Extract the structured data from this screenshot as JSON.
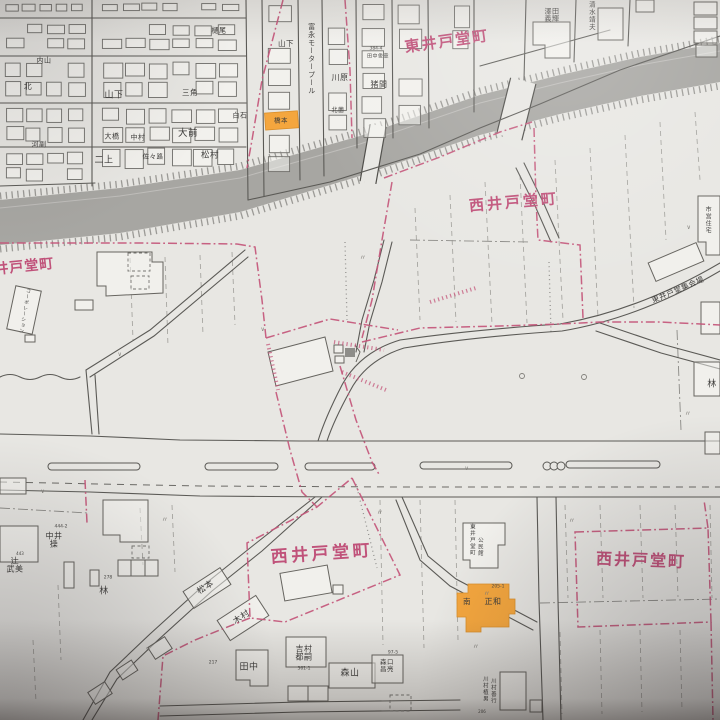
{
  "colors": {
    "paper": "#e8e7e3",
    "band_gray": "#a7a6a2",
    "boundary_pink": "#c4567a",
    "label_pink": "#c0527a",
    "highlight_orange": "#f4a63e",
    "ink": "#3f3e3c"
  },
  "district_labels": [
    {
      "t": "東井戸堂町",
      "x": 447,
      "y": 42,
      "s": 15,
      "r": -8,
      "ls": 2
    },
    {
      "t": "西井戸堂町",
      "x": 514,
      "y": 203,
      "s": 15,
      "r": -5,
      "ls": 3
    },
    {
      "t": "西井戸堂町",
      "x": 17,
      "y": 268,
      "s": 14,
      "r": -6,
      "ls": 1
    },
    {
      "t": "西井戸堂町",
      "x": 322,
      "y": 555,
      "s": 17,
      "r": -4,
      "ls": 3.5
    },
    {
      "t": "西井戸堂町",
      "x": 641,
      "y": 561,
      "s": 16,
      "r": 2,
      "ls": 2
    }
  ],
  "name_labels": [
    {
      "t": "内山",
      "x": 44,
      "y": 61,
      "s": 7
    },
    {
      "t": "北",
      "x": 28,
      "y": 87,
      "s": 8
    },
    {
      "t": "山下",
      "x": 114,
      "y": 96,
      "s": 9
    },
    {
      "t": "三角",
      "x": 190,
      "y": 93,
      "s": 7.5
    },
    {
      "t": "樋尾",
      "x": 219,
      "y": 31,
      "s": 7
    },
    {
      "t": "白石",
      "x": 240,
      "y": 116,
      "s": 7
    },
    {
      "t": "大橋",
      "x": 112,
      "y": 137,
      "s": 7
    },
    {
      "t": "中村",
      "x": 138,
      "y": 138,
      "s": 7
    },
    {
      "t": "河副",
      "x": 39,
      "y": 145,
      "s": 7
    },
    {
      "t": "二上",
      "x": 104,
      "y": 161,
      "s": 9
    },
    {
      "t": "佐々路",
      "x": 153,
      "y": 157,
      "s": 6.5
    },
    {
      "t": "大前",
      "x": 188,
      "y": 134,
      "s": 9.5
    },
    {
      "t": "松村",
      "x": 210,
      "y": 156,
      "s": 8.5
    },
    {
      "t": "山下",
      "x": 286,
      "y": 44,
      "s": 7.5
    },
    {
      "t": "川原",
      "x": 340,
      "y": 78,
      "s": 8
    },
    {
      "t": "猪間",
      "x": 379,
      "y": 85,
      "s": 8
    },
    {
      "t": "北薗",
      "x": 338,
      "y": 111,
      "s": 6
    },
    {
      "t": "田中俊章",
      "x": 378,
      "y": 57,
      "s": 5
    },
    {
      "t": "澤田\n義輝",
      "x": 552,
      "y": 16,
      "s": 7,
      "m": 1
    },
    {
      "t": "清水靖夫",
      "x": 591,
      "y": 16,
      "s": 6.5,
      "v": 1
    },
    {
      "t": "富永モータープール",
      "x": 311,
      "y": 59,
      "s": 7,
      "v": 1
    },
    {
      "t": "市営住宅",
      "x": 707,
      "y": 220,
      "s": 6,
      "v": 1
    },
    {
      "t": "コーポレーション",
      "x": 24,
      "y": 311,
      "s": 4.8,
      "v": 1,
      "r": 10
    },
    {
      "t": "東井戸堂集会場",
      "x": 678,
      "y": 290,
      "s": 7.5,
      "r": -23
    },
    {
      "t": "林",
      "x": 712,
      "y": 385,
      "s": 9
    },
    {
      "t": "中井\n操",
      "x": 54,
      "y": 541,
      "s": 8,
      "m": 1
    },
    {
      "t": "辻\n武美",
      "x": 15,
      "y": 566,
      "s": 8,
      "m": 1
    },
    {
      "t": "林",
      "x": 104,
      "y": 592,
      "s": 9
    },
    {
      "t": "松本",
      "x": 206,
      "y": 588,
      "s": 8.5,
      "r": -33
    },
    {
      "t": "木村",
      "x": 242,
      "y": 618,
      "s": 8.5,
      "r": -33
    },
    {
      "t": "田中",
      "x": 249,
      "y": 668,
      "s": 9
    },
    {
      "t": "吉村\n都嗣",
      "x": 304,
      "y": 654,
      "s": 8,
      "m": 1
    },
    {
      "t": "森山",
      "x": 350,
      "y": 674,
      "s": 9
    },
    {
      "t": "森口\n昌亮",
      "x": 387,
      "y": 666,
      "s": 6.5,
      "m": 1
    },
    {
      "t": "川村植男",
      "x": 484,
      "y": 689,
      "s": 5.5,
      "v": 1
    },
    {
      "t": "川村善行",
      "x": 492,
      "y": 691,
      "s": 5.5,
      "v": 1
    },
    {
      "t": "東井戸堂町",
      "x": 471,
      "y": 540,
      "s": 5.5,
      "v": 1
    },
    {
      "t": "公民館",
      "x": 479,
      "y": 547,
      "s": 5.5,
      "v": 1
    },
    {
      "t": "南",
      "x": 467,
      "y": 602,
      "s": 7.5
    },
    {
      "t": "正和",
      "x": 493,
      "y": 602,
      "s": 8
    },
    {
      "t": "橋本",
      "x": 281,
      "y": 121,
      "s": 6.5
    }
  ],
  "lot_numbers": [
    {
      "t": "384-4",
      "x": 376,
      "y": 50,
      "s": 4.5
    },
    {
      "t": "444-2",
      "x": 61,
      "y": 528,
      "s": 4.5
    },
    {
      "t": "443",
      "x": 20,
      "y": 554,
      "s": 4
    },
    {
      "t": "278",
      "x": 108,
      "y": 579,
      "s": 4.5
    },
    {
      "t": "217",
      "x": 213,
      "y": 664,
      "s": 4.5
    },
    {
      "t": "361-1",
      "x": 304,
      "y": 670,
      "s": 4.5
    },
    {
      "t": "97-5",
      "x": 393,
      "y": 654,
      "s": 4.5
    },
    {
      "t": "205-1",
      "x": 498,
      "y": 588,
      "s": 4.5
    },
    {
      "t": "206",
      "x": 482,
      "y": 712,
      "s": 4
    }
  ],
  "field_marks": [
    {
      "t": "〃",
      "x": 165,
      "y": 520,
      "s": 7
    },
    {
      "t": "〃",
      "x": 380,
      "y": 513,
      "s": 7
    },
    {
      "t": "〃",
      "x": 487,
      "y": 594,
      "s": 7
    },
    {
      "t": "〃",
      "x": 572,
      "y": 521,
      "s": 7
    },
    {
      "t": "〃",
      "x": 688,
      "y": 414,
      "s": 7
    },
    {
      "t": "〃",
      "x": 476,
      "y": 647,
      "s": 7
    },
    {
      "t": "〃",
      "x": 363,
      "y": 258,
      "s": 7
    },
    {
      "t": "∨",
      "x": 120,
      "y": 355,
      "s": 6
    },
    {
      "t": "∨",
      "x": 263,
      "y": 330,
      "s": 6
    },
    {
      "t": "∨",
      "x": 467,
      "y": 469,
      "s": 6
    },
    {
      "t": "∨",
      "x": 43,
      "y": 492,
      "s": 6
    },
    {
      "t": "∨",
      "x": 148,
      "y": 650,
      "s": 6
    },
    {
      "t": "∨",
      "x": 689,
      "y": 228,
      "s": 6
    }
  ]
}
